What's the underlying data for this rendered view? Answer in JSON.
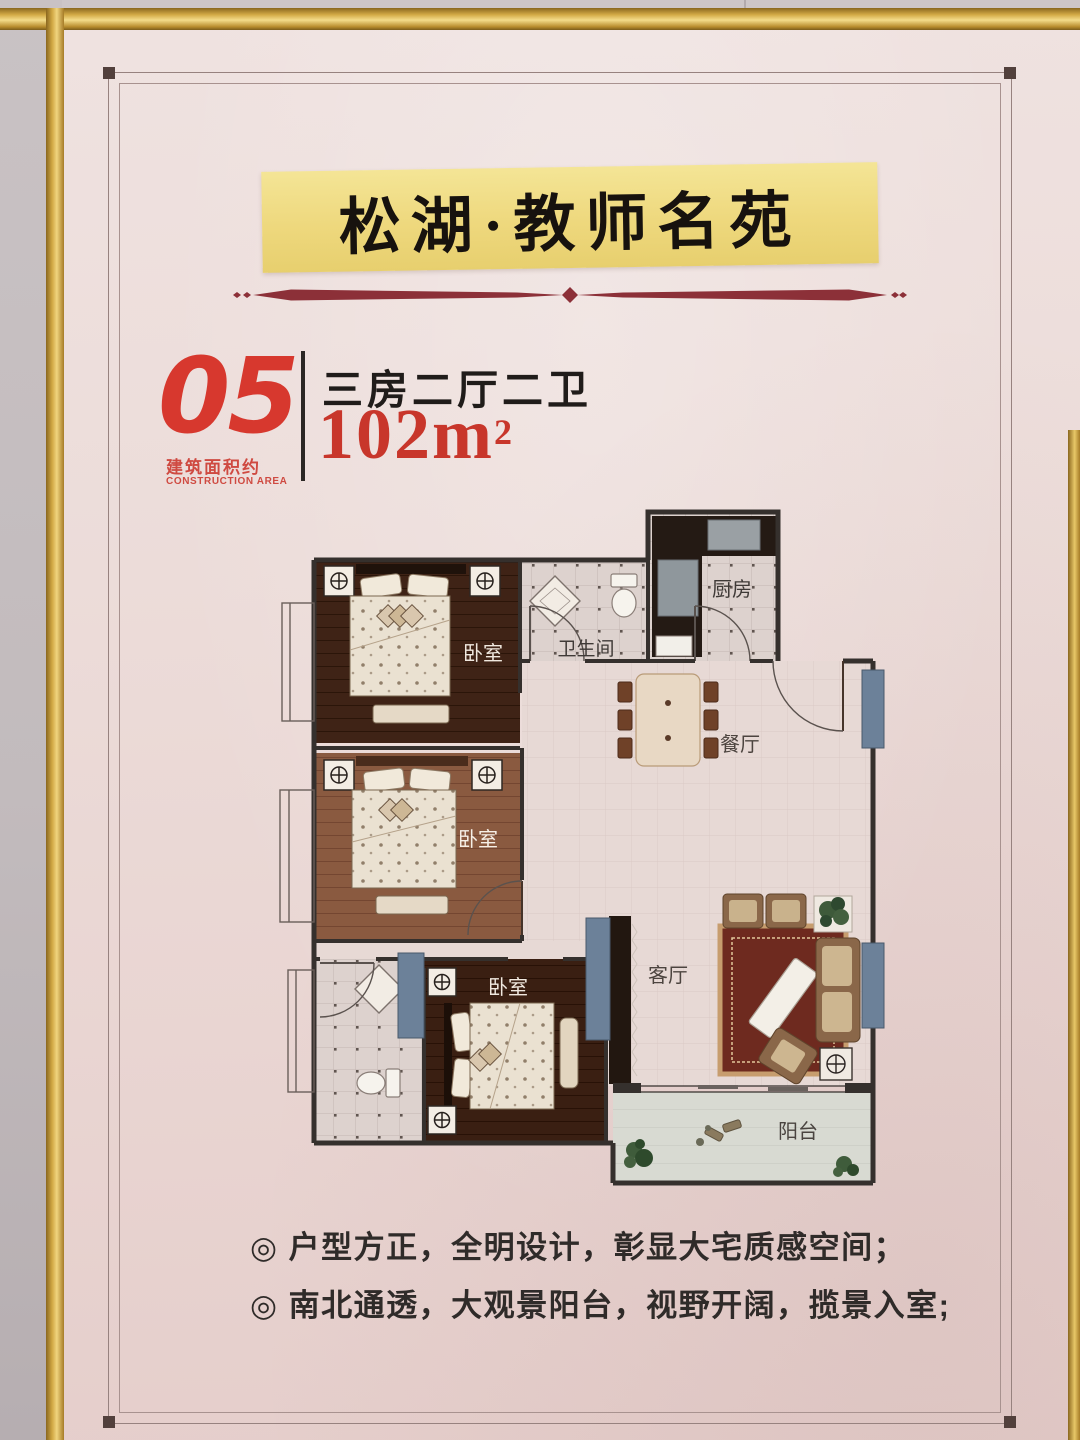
{
  "poster": {
    "title": "松湖·教师名苑",
    "unit": {
      "number": "05",
      "area_note_cn": "建筑面积约",
      "area_note_en": "CONSTRUCTION AREA",
      "layout": "三房二厅二卫",
      "area": "102m",
      "area_sup": "2"
    },
    "features": {
      "line1": "◎ 户型方正，全明设计，彰显大宅质感空间；",
      "line2": "◎ 南北通透，大观景阳台，视野开阔，揽景入室;"
    }
  },
  "floor_plan": {
    "rooms": {
      "bedroom1": "卧室",
      "bedroom2": "卧室",
      "bedroom3": "卧室",
      "bathroom": "卫生间",
      "kitchen": "厨房",
      "dining": "餐厅",
      "living": "客厅",
      "balcony": "阳台"
    }
  },
  "colors": {
    "accent_red": "#d7382e",
    "banner_yellow": "#eed87d",
    "window_blue": "#6c8199",
    "divider_maroon": "#8c3038",
    "frame_gold": "#d2a945"
  }
}
